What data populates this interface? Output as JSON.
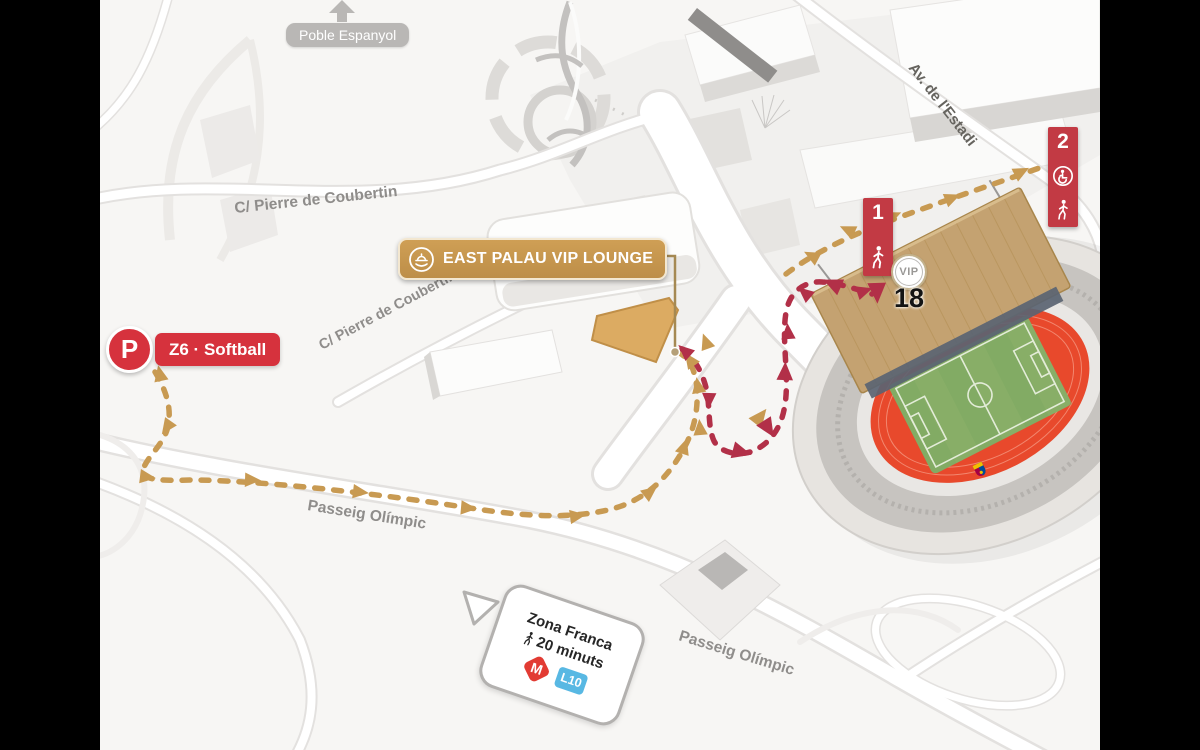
{
  "map": {
    "streets": {
      "coubertin": "C/ Pierre de Coubertin",
      "passeig": "Passeig Olímpic",
      "estadi": "Av. de l'Estadi"
    },
    "poi": {
      "poble_espanyol": "Poble Espanyol"
    },
    "lounge": {
      "label": "EAST PALAU VIP LOUNGE"
    },
    "parking": {
      "symbol": "P",
      "label": "Z6 · Softball"
    },
    "waypoints": {
      "w1": {
        "number": "1",
        "icon": "pedestrian"
      },
      "w2": {
        "number": "2",
        "icons": "wheelchair + pedestrian"
      },
      "vip": "VIP",
      "gate": "18"
    },
    "callout": {
      "title": "Zona Franca",
      "walk_time": "20 minuts",
      "metro": "M",
      "line": "L10"
    },
    "routes": [
      {
        "name": "pedestrian-route-gold",
        "color": "#c89a52",
        "style": "dashed with arrowheads"
      },
      {
        "name": "vip-access-route-crimson",
        "color": "#b23048",
        "style": "dashed with arrowheads"
      }
    ],
    "colors": {
      "route_gold": "#c89a52",
      "route_crimson": "#b23048",
      "brand_red": "#d6323d",
      "banner_gold": "#c6984f",
      "track_red": "#e8492c",
      "pitch_green": "#82ab64",
      "roof_tan": "#c4a271",
      "metro_red": "#e23b33",
      "line10_blue": "#58b8e3"
    }
  }
}
